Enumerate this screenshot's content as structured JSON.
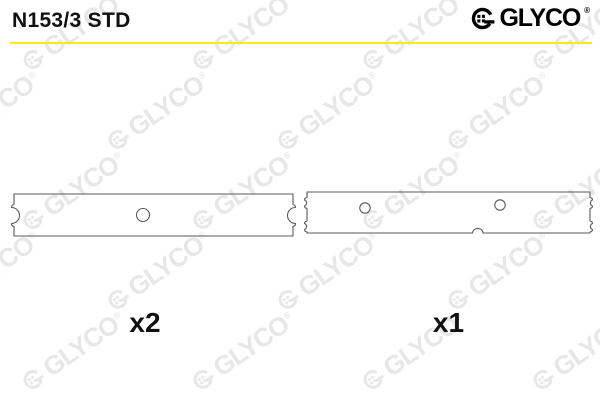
{
  "header": {
    "part_number": "N153/3 STD",
    "divider_color": "#FFEC00"
  },
  "brand": {
    "name": "GLYCO",
    "registered_mark": "®",
    "logo_icon": "glyco-ring-dots-icon",
    "color": "#000000"
  },
  "watermark": {
    "text": "GLYCO",
    "registered_mark": "®",
    "color": "#E7E7E7",
    "angle_deg": -35
  },
  "drawing": {
    "stroke_color": "#5A5A5A",
    "parts": [
      {
        "quantity_label": "x2",
        "holes": 1
      },
      {
        "quantity_label": "x1",
        "holes": 2
      }
    ]
  }
}
